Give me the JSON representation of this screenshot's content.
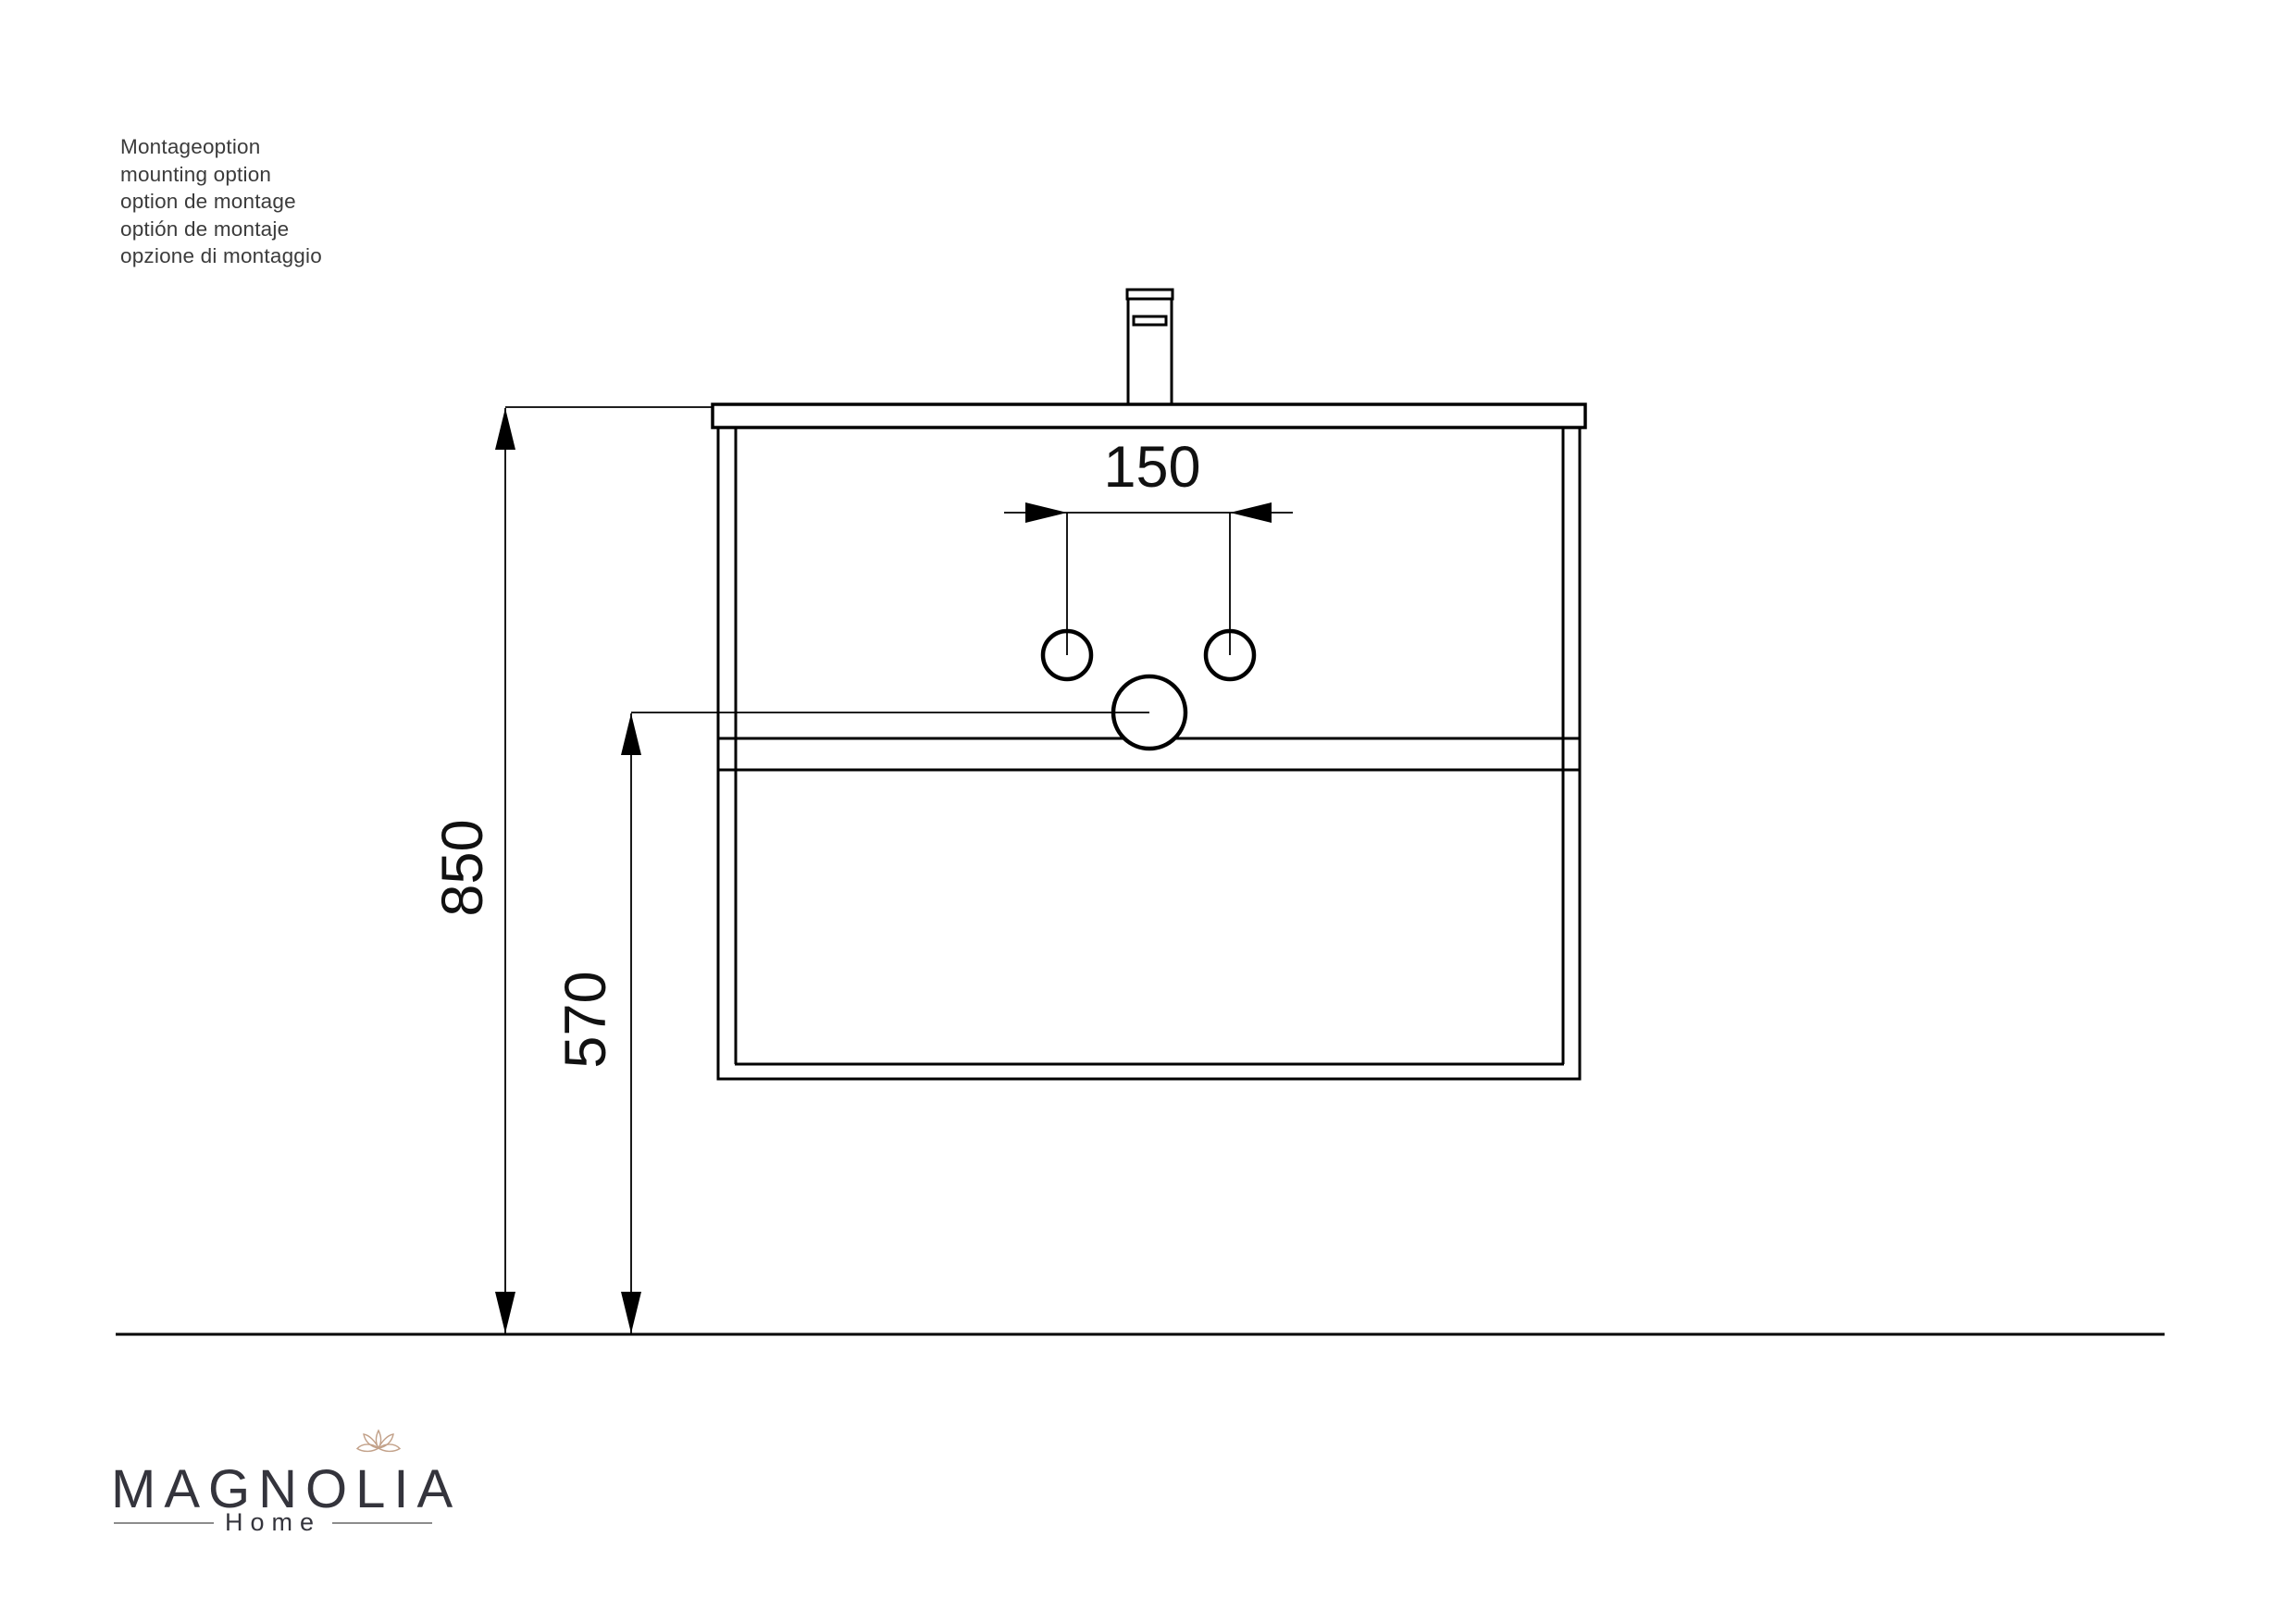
{
  "notes": {
    "lines": [
      "Montageoption",
      "mounting option",
      "option de montage",
      "optión de montaje",
      "opzione di montaggio"
    ]
  },
  "dimensions": {
    "total_height_mm": "850",
    "drain_height_mm": "570",
    "tap_hole_spacing_mm": "150"
  },
  "logo": {
    "brand": "MAGNOLIA",
    "tagline": "Home"
  },
  "colors": {
    "line": "#000000",
    "dim_text": "#111111",
    "note_text": "#3b3b3b",
    "logo_text": "#34343c",
    "logo_divider": "#8c8c8c",
    "flower": "#c2a189"
  }
}
